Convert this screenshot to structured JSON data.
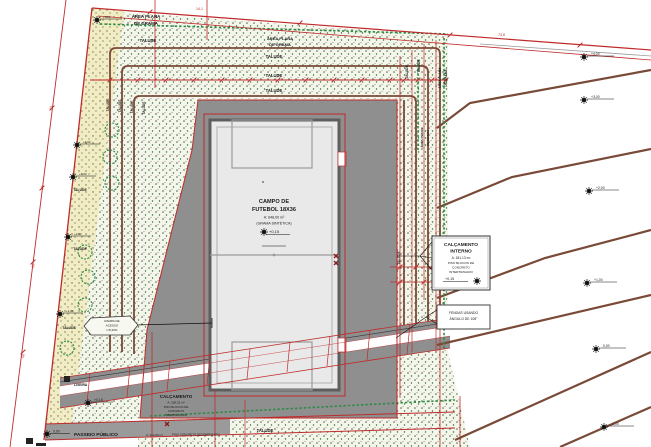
{
  "colors": {
    "dimension_red": "#bf2b2b",
    "contour_brown": "#7a4a38",
    "grass_green": "#2e8b46",
    "paving_gray": "#8f8f8f",
    "field_fill": "#e9e9e9",
    "talude_yellow": "#f1ecc4"
  },
  "labels": {
    "area_plana_l1": "ÁREA PLANA",
    "area_plana_l2": "DE GRAMA",
    "talude": "TALUDE",
    "lixeira": "LIXEIRA"
  },
  "field": {
    "title1": "CAMPO DE",
    "title2": "FUTEBOL 18X36",
    "area": "A: 648,00 m²",
    "surface": "(GRAMA SINTÉTICA)",
    "elevation": "+0,15"
  },
  "calcamento_interno": {
    "title1": "CALÇAMENTO",
    "title2": "INTERNO",
    "area": "A: 181,13 m²",
    "mat1": "PISO BLOCOS DE",
    "mat2": "CONCRETO",
    "mat3": "INTERTRAVADO",
    "elevation": "+0,15"
  },
  "calcamento": {
    "title": "CALÇAMENTO",
    "area": "A: 258,03 m²",
    "mat1": "PISO BLOCOS DE",
    "mat2": "CONCRETO",
    "mat3": "INTERTRAVADO",
    "elevation": "+0,15"
  },
  "passeio": {
    "title": "PASSEIO PÚBLICO",
    "area": "A: 112,06 m²",
    "material": "PISO CONCRETO DESEMPENADO",
    "elevation": "0,00"
  },
  "note_box": {
    "l1": "FENDAS USANDO",
    "l2": "ÂNGULO DE 108°"
  },
  "ramp_callout": {
    "l1": "RAMPA DE",
    "l2": "ACESSO",
    "l3": "i=8,33%"
  },
  "elevations": {
    "right": [
      "+4,00",
      "+3,00",
      "+2,00",
      "+1,00",
      "0,00",
      "-1,00"
    ],
    "left": [
      "+5,00",
      "+4,00",
      "+3,00",
      "+2,00",
      "+1,00"
    ]
  },
  "dims": {
    "left": [
      "15",
      "18",
      "20",
      "50"
    ],
    "top": [
      "14,1",
      "74,8"
    ]
  }
}
